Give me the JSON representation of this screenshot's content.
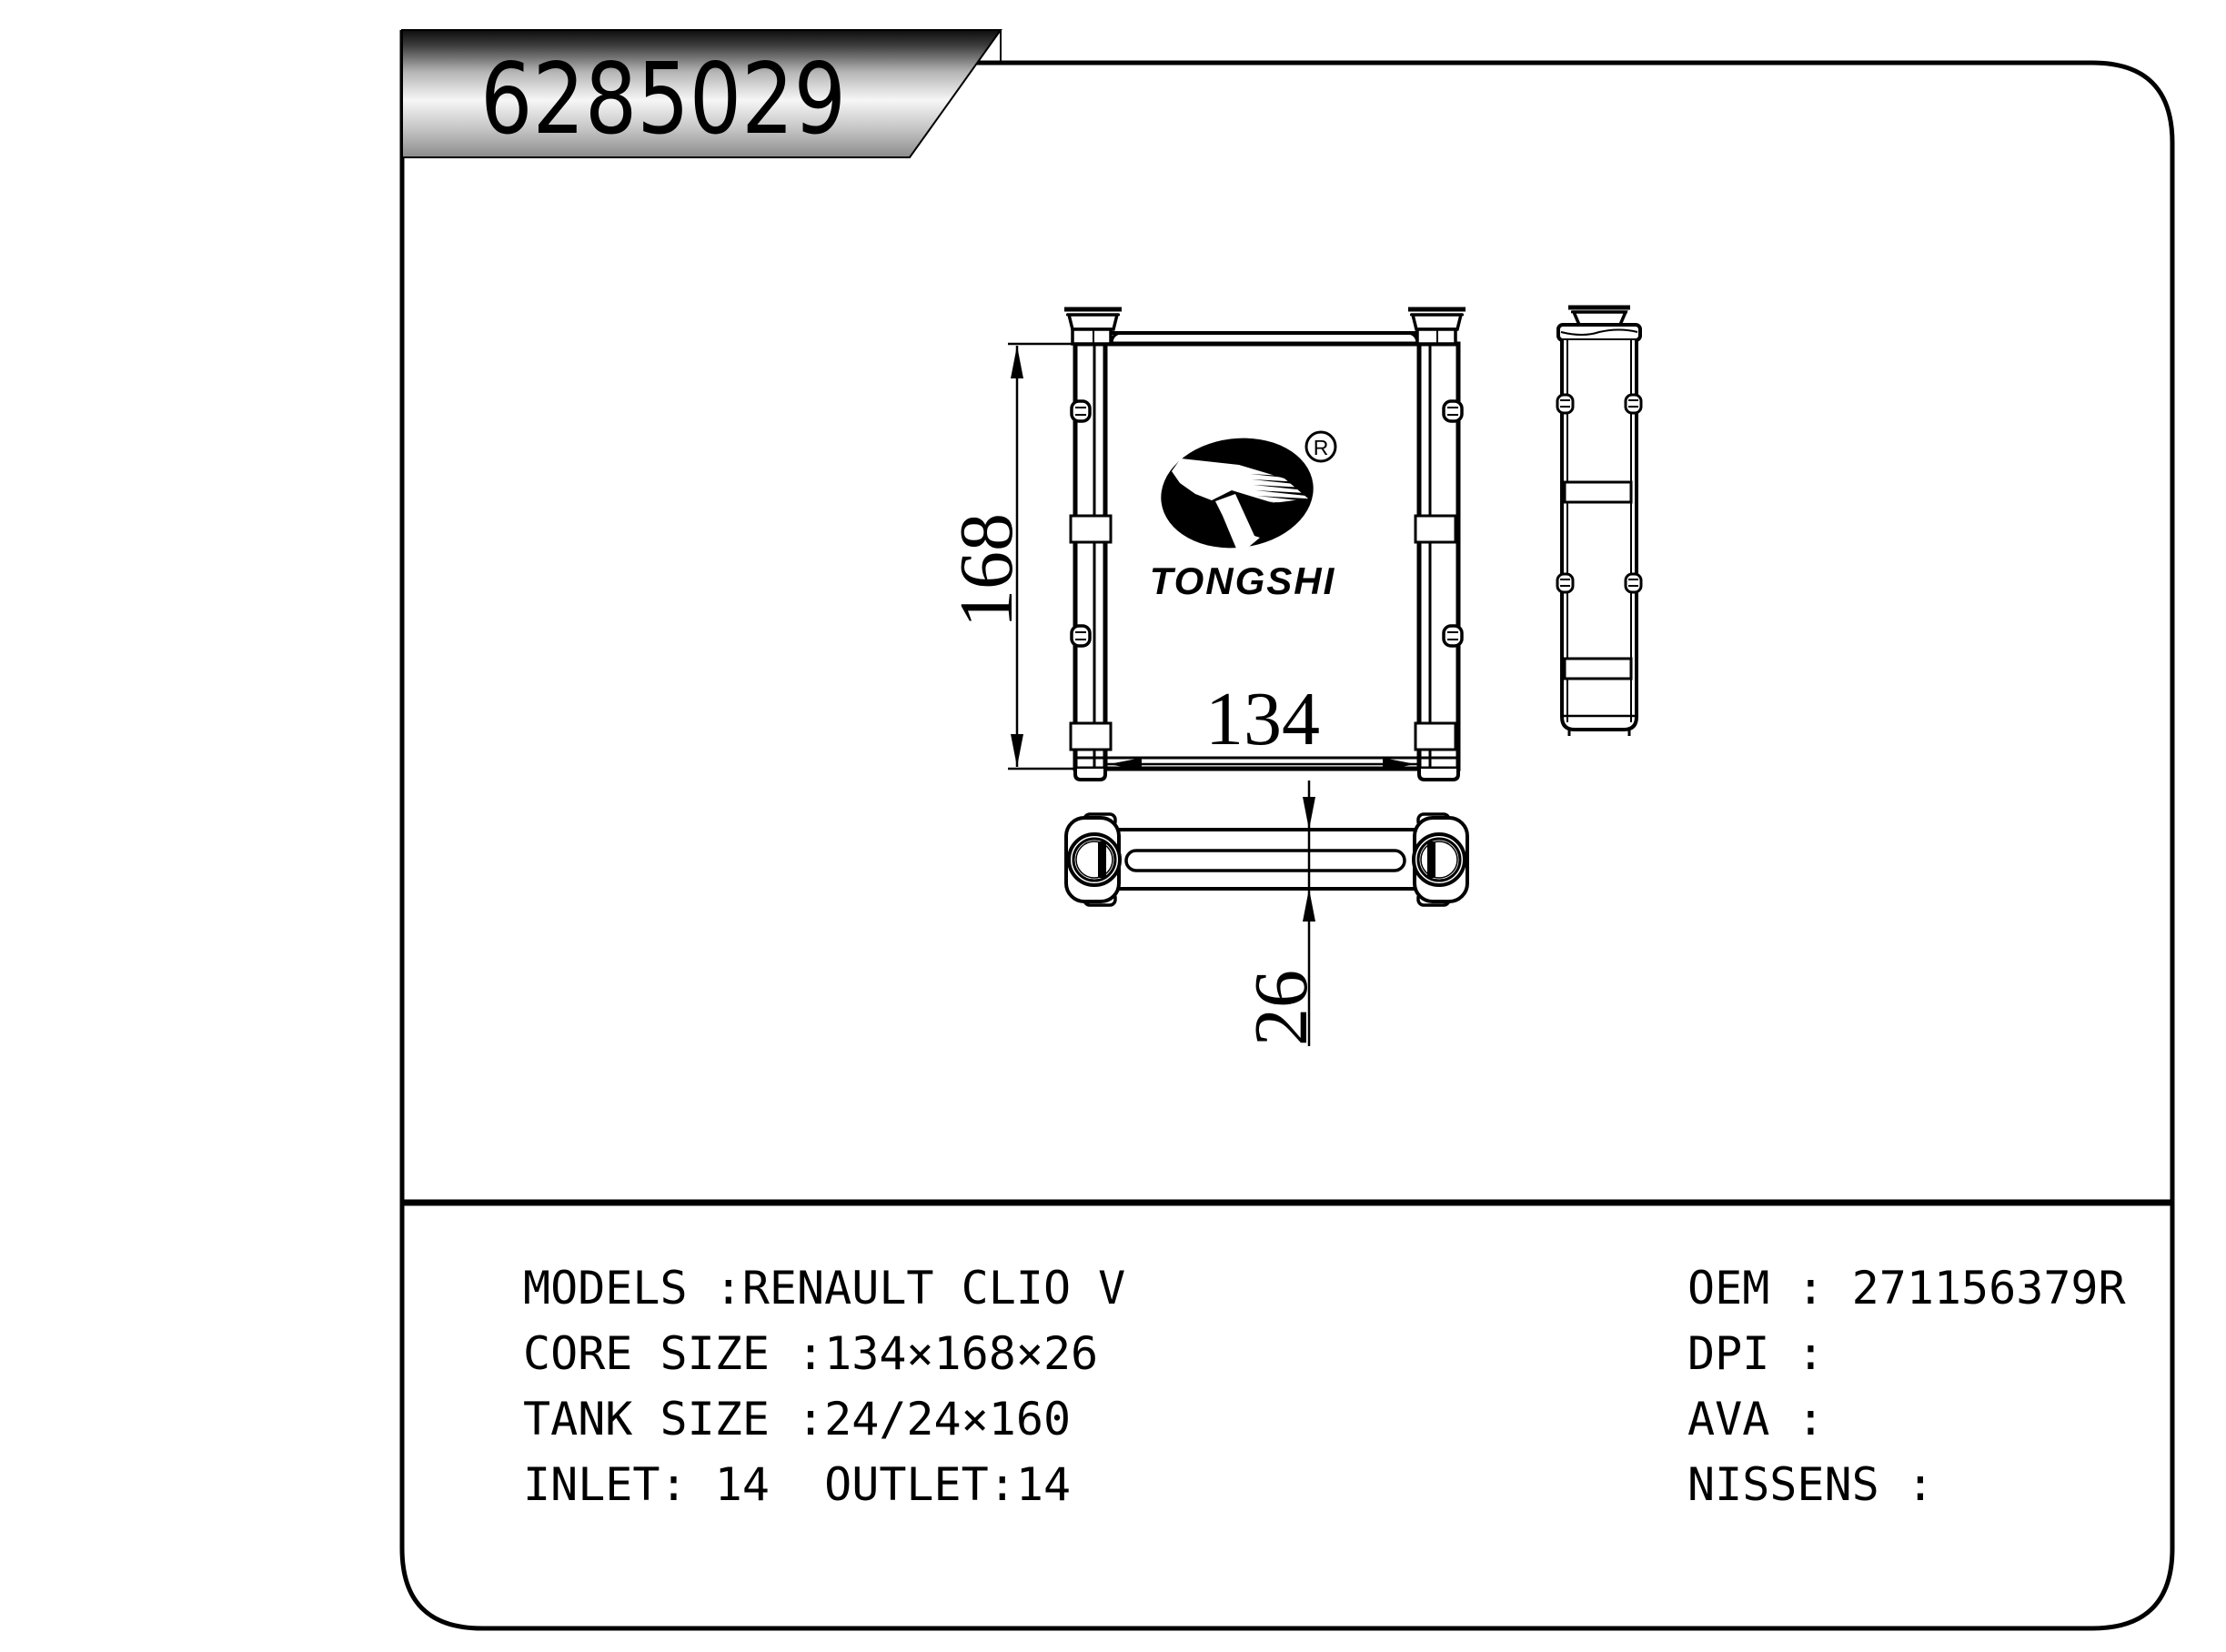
{
  "page": {
    "background": "#ffffff",
    "line_color": "#000000"
  },
  "banner": {
    "part_number": "6285029",
    "gradient_top": "#0d0d0d",
    "gradient_middle": "#f6f6f6",
    "gradient_bottom": "#8c8c8c"
  },
  "logo": {
    "brand": "TONGSHI",
    "registered_mark": "R"
  },
  "drawing": {
    "dimensions": {
      "core_height": "168",
      "core_width": "134",
      "core_depth": "26"
    }
  },
  "specs": {
    "left_column": [
      "MODELS :RENAULT CLIO V",
      "CORE SIZE :134×168×26",
      "TANK SIZE :24/24×160",
      "INLET: 14  OUTLET:14"
    ],
    "right_column": [
      "OEM : 271156379R",
      "DPI :",
      "AVA :",
      "NISSENS :"
    ]
  }
}
